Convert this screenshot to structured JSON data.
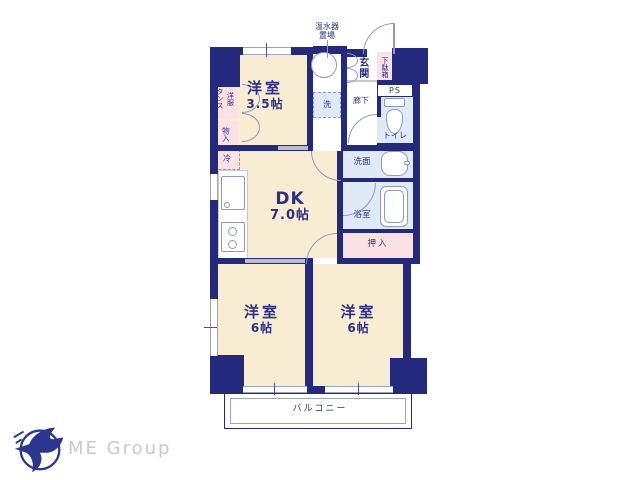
{
  "colors": {
    "wall": "#232a7e",
    "room_fill": "#f8edd3",
    "closet_fill": "#fbe0e4",
    "wet_area_fill": "#dfeaf6",
    "fixture_line": "#8f99c0",
    "text": "#2b3186",
    "logo": "#2b3690",
    "logo_text": "#c9c9c9"
  },
  "plan": {
    "rooms": {
      "west35": {
        "label": "洋室",
        "size": "3.5帖"
      },
      "dk": {
        "label": "DK",
        "size": "7.0帖"
      },
      "west6a": {
        "label": "洋室",
        "size": "6帖"
      },
      "west6b": {
        "label": "洋室",
        "size": "6帖"
      },
      "balcony": {
        "label": "バルコニー"
      },
      "genkan": {
        "label": "玄関"
      },
      "getabako": {
        "label": "下駄箱"
      },
      "ps": {
        "label": "PS"
      },
      "toilet": {
        "label": "トイレ"
      },
      "corridor": {
        "label": "廊下"
      },
      "senmen": {
        "label": "洗面"
      },
      "bath": {
        "label": "浴室"
      },
      "oshiire": {
        "label": "押入"
      },
      "tansu": {
        "label": "洋服\nタンス"
      },
      "mononyu": {
        "label": "物入"
      },
      "fridge": {
        "label": "冷"
      },
      "laundry": {
        "label": "洗"
      },
      "heater": {
        "label": "温水器\n置場"
      }
    }
  },
  "footer": {
    "logo_text": "ME Group"
  }
}
